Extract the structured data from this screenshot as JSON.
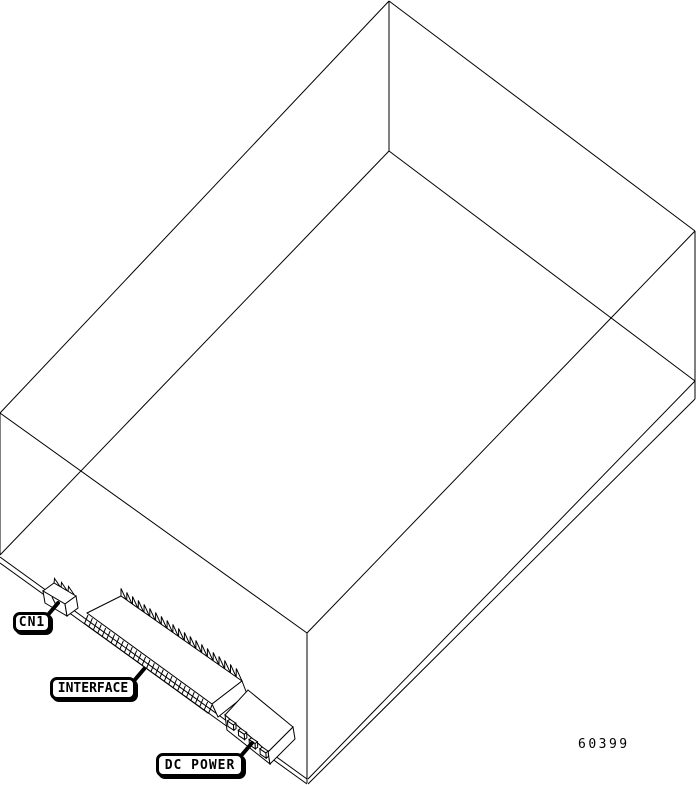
{
  "figure": {
    "part_number": "60399",
    "callouts": {
      "cn1": {
        "label": "CN1"
      },
      "interface": {
        "label": "INTERFACE"
      },
      "dc_power": {
        "label": "DC POWER"
      }
    },
    "line_color": "#000000",
    "background_color": "#ffffff"
  }
}
